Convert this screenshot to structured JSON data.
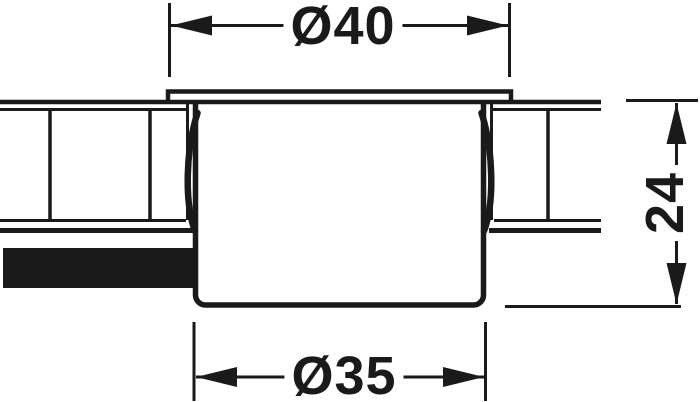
{
  "figure": {
    "type": "technical-drawing-cross-section",
    "dimension_labels": {
      "flange_diameter": "Ø40",
      "body_diameter": "Ø35",
      "depth": "24"
    },
    "colors": {
      "line": "#1a1a1a",
      "background": "#ffffff"
    }
  }
}
